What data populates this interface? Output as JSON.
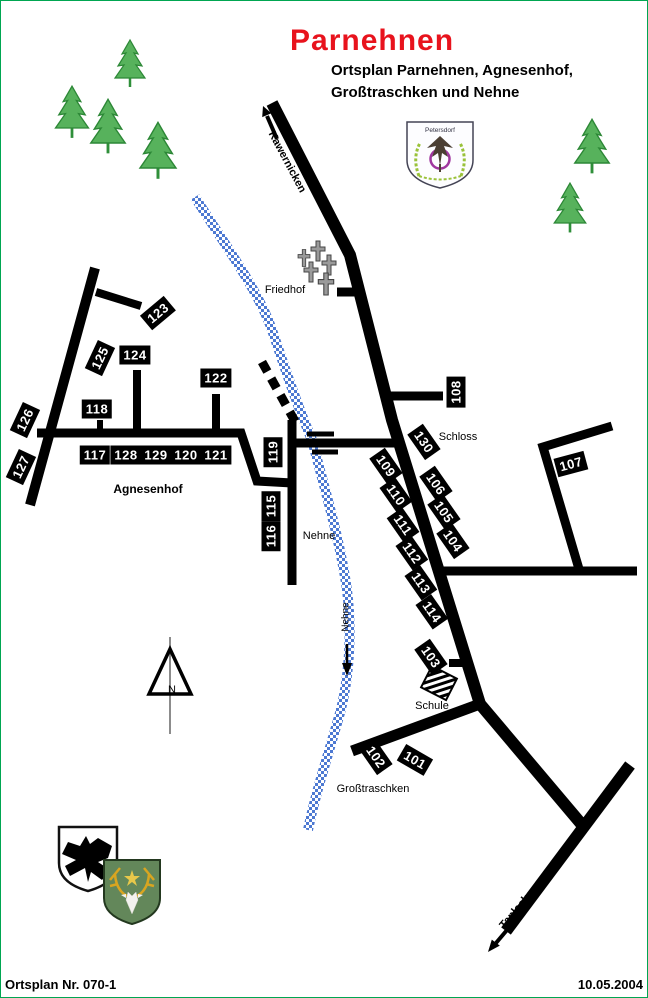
{
  "header": {
    "title": "Parnehnen",
    "subtitle1": "Ortsplan Parnehnen, Agnesenhof,",
    "subtitle2": "Großtraschken und Nehne"
  },
  "footer": {
    "plan_no": "Ortsplan Nr. 070-1",
    "date": "10.05.2004"
  },
  "colors": {
    "title_red": "#e8131d",
    "road_black": "#000000",
    "river_blue": "#4d79d2",
    "tree_green": "#2f9e41",
    "frame_green": "#00a651"
  },
  "crests": {
    "petersdorf_label": "Petersdorf"
  },
  "compass": {
    "label": "N"
  },
  "houses": [
    {
      "no": "101",
      "x": 415,
      "y": 760,
      "rot": 30
    },
    {
      "no": "102",
      "x": 376,
      "y": 757,
      "rot": 55
    },
    {
      "no": "103",
      "x": 431,
      "y": 657,
      "rot": 55
    },
    {
      "no": "104",
      "x": 453,
      "y": 541,
      "rot": 55
    },
    {
      "no": "105",
      "x": 444,
      "y": 512,
      "rot": 55
    },
    {
      "no": "106",
      "x": 436,
      "y": 484,
      "rot": 55
    },
    {
      "no": "107",
      "x": 571,
      "y": 464,
      "rot": -15
    },
    {
      "no": "108",
      "x": 456,
      "y": 392,
      "rot": -90
    },
    {
      "no": "109",
      "x": 386,
      "y": 466,
      "rot": 55
    },
    {
      "no": "110",
      "x": 396,
      "y": 495,
      "rot": 55
    },
    {
      "no": "111",
      "x": 403,
      "y": 525,
      "rot": 55
    },
    {
      "no": "112",
      "x": 412,
      "y": 553,
      "rot": 55
    },
    {
      "no": "113",
      "x": 421,
      "y": 583,
      "rot": 55
    },
    {
      "no": "114",
      "x": 432,
      "y": 612,
      "rot": 55
    },
    {
      "no": "115",
      "x": 271,
      "y": 506,
      "rot": -90
    },
    {
      "no": "116",
      "x": 271,
      "y": 536,
      "rot": -90
    },
    {
      "no": "117",
      "x": 95,
      "y": 455,
      "rot": 0
    },
    {
      "no": "118",
      "x": 97,
      "y": 409,
      "rot": 0
    },
    {
      "no": "119",
      "x": 273,
      "y": 452,
      "rot": -90
    },
    {
      "no": "120",
      "x": 186,
      "y": 455,
      "rot": 0
    },
    {
      "no": "121",
      "x": 216,
      "y": 455,
      "rot": 0
    },
    {
      "no": "122",
      "x": 216,
      "y": 378,
      "rot": 0
    },
    {
      "no": "123",
      "x": 158,
      "y": 313,
      "rot": -40
    },
    {
      "no": "124",
      "x": 135,
      "y": 355,
      "rot": 0
    },
    {
      "no": "125",
      "x": 100,
      "y": 358,
      "rot": -65
    },
    {
      "no": "126",
      "x": 25,
      "y": 420,
      "rot": -65
    },
    {
      "no": "127",
      "x": 21,
      "y": 467,
      "rot": -65
    },
    {
      "no": "128",
      "x": 126,
      "y": 455,
      "rot": 0
    },
    {
      "no": "129",
      "x": 156,
      "y": 455,
      "rot": 0
    },
    {
      "no": "130",
      "x": 424,
      "y": 442,
      "rot": 55
    }
  ],
  "places": [
    {
      "text": "Friedhof",
      "x": 285,
      "y": 290
    },
    {
      "text": "Schloss",
      "x": 458,
      "y": 437
    },
    {
      "text": "Nehne",
      "x": 319,
      "y": 536
    },
    {
      "text": "Schule",
      "x": 432,
      "y": 706
    },
    {
      "text": "Großtraschken",
      "x": 373,
      "y": 789
    },
    {
      "text": "Agnesenhof",
      "x": 148,
      "y": 489,
      "cls": "bold"
    }
  ],
  "signs": [
    {
      "text": "Kawernicken",
      "x": 287,
      "y": 162,
      "rot": 62
    },
    {
      "text": "Taplacken",
      "x": 519,
      "y": 907,
      "rot": -50
    },
    {
      "text": "Nehne",
      "x": 346,
      "y": 617,
      "rot": -90,
      "cls": "river"
    }
  ]
}
